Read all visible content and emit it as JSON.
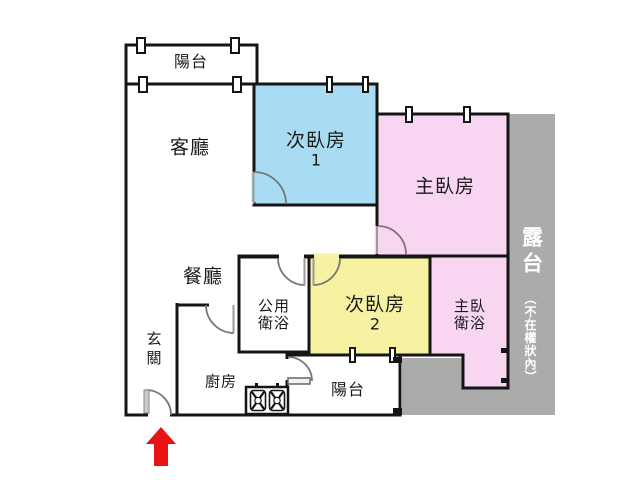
{
  "plan": {
    "balcony_top": "陽台",
    "living_room": "客廳",
    "bedroom_2_1": "次臥房",
    "bedroom_2_1_num": "1",
    "master_bedroom": "主臥房",
    "dining_room": "餐廳",
    "shared_bath_line1": "公用",
    "shared_bath_line2": "衛浴",
    "bedroom_2_2": "次臥房",
    "bedroom_2_2_num": "2",
    "master_bath_line1": "主臥",
    "master_bath_line2": "衛浴",
    "entryway": "玄關",
    "kitchen": "廚房",
    "balcony_bottom": "陽台",
    "terrace": "露台",
    "terrace_note": "（不在權狀內）"
  },
  "colors": {
    "bedroom_blue": "#a8dcf2",
    "room_pink": "#f8d6f2",
    "room_yellow": "#f6f2a2",
    "terrace_gray": "#ababab",
    "arrow_red": "#e81414",
    "wall": "#151515"
  }
}
